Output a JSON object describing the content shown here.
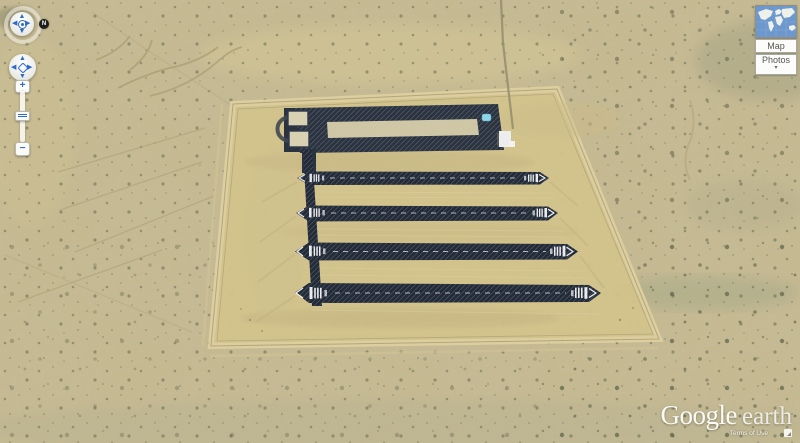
{
  "app_title": "Google Earth",
  "navigation": {
    "north_button": "N",
    "look_joystick": {
      "up": "▲",
      "down": "▼",
      "left": "◀",
      "right": "▶"
    },
    "move_joystick": {
      "up": "▲",
      "down": "▼",
      "left": "◀",
      "right": "▶"
    },
    "zoom": {
      "in_label": "+",
      "out_label": "−"
    }
  },
  "layers_panel": {
    "map_button_label": "Map",
    "photos_button_label": "Photos",
    "photos_dropdown_arrow": "▾"
  },
  "watermark": {
    "brand": "Google",
    "product": "earth",
    "terms_link": "Terms of Use"
  },
  "scene_colors": {
    "desert_base": "#c6ba91",
    "compound_interior": "#d3c38c",
    "perimeter_road": "#ddd0a0",
    "runway_dark": "#232b38",
    "pad_inner_strip": "#d8cfac",
    "water_tank_blue": "#8ed6e6",
    "ocean_thumb_blue": "#6d98cd"
  }
}
